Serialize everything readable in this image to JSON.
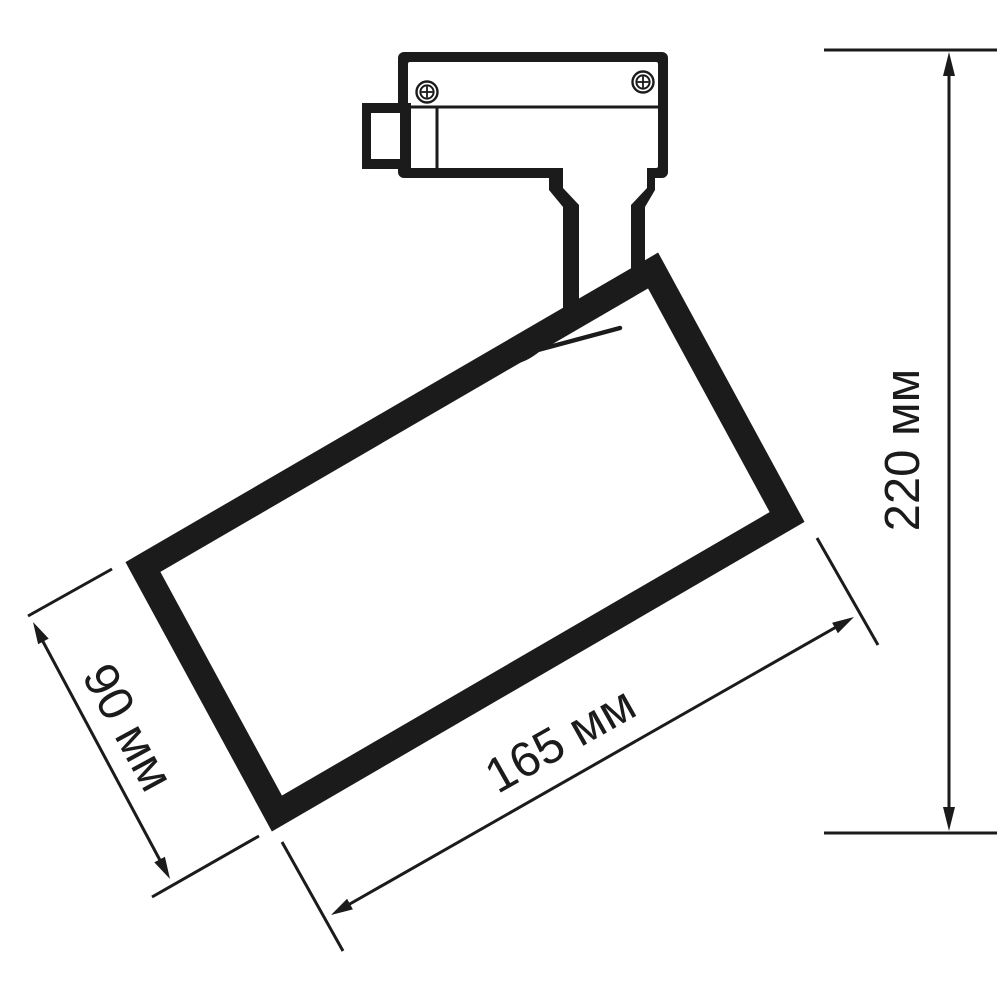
{
  "drawing": {
    "type": "technical-dimension-drawing",
    "subject": "track-mounted-spotlight",
    "dimensions": {
      "height": {
        "label": "220 мм",
        "value": "220",
        "unit": "мм"
      },
      "length": {
        "label": "165 мм",
        "value": "165",
        "unit": "мм"
      },
      "diameter": {
        "label": "90 мм",
        "value": "90",
        "unit": "мм"
      }
    },
    "colors": {
      "ink": "#1b1b1b",
      "background": "#ffffff"
    },
    "icons": [
      "phillips-screw-icon",
      "phillips-screw-icon"
    ]
  }
}
